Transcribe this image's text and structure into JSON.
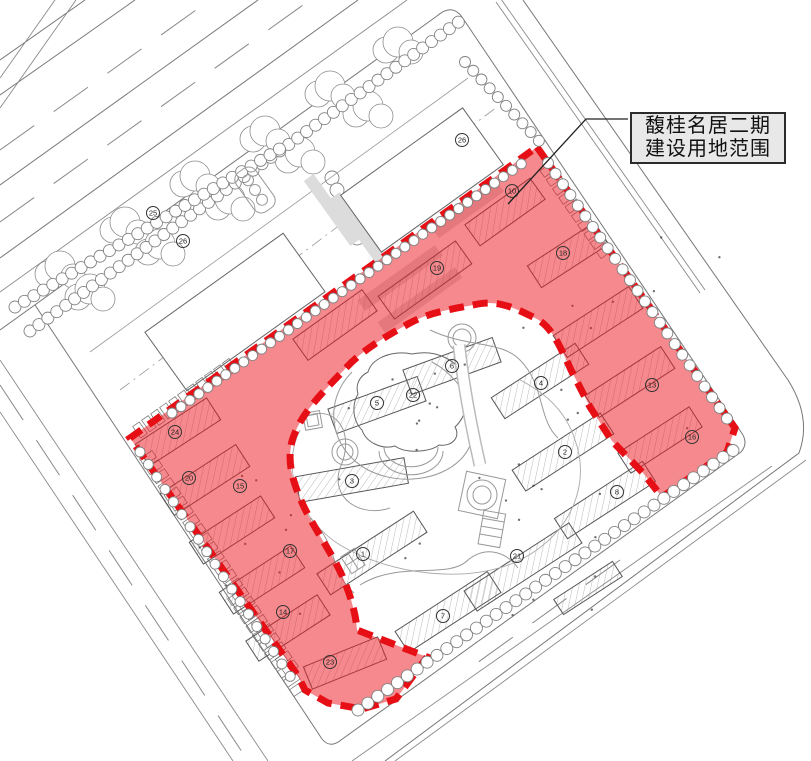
{
  "annotation": {
    "line1": "馥桂名居二期",
    "line2": "建设用地范围"
  },
  "colors": {
    "red_fill": "#ed1c24",
    "red_fill_opacity": "0.52",
    "red_dash": "#e60f16",
    "cad_line": "#777777",
    "label_bg": "#e8e8e8",
    "label_border": "#2b2b2b",
    "label_text": "#111111"
  },
  "building_numbers": [
    {
      "label": "25",
      "x": 153,
      "y": 213
    },
    {
      "label": "26",
      "x": 183,
      "y": 241
    },
    {
      "label": "26",
      "x": 462,
      "y": 140
    },
    {
      "label": "10",
      "x": 512,
      "y": 191
    },
    {
      "label": "18",
      "x": 563,
      "y": 253
    },
    {
      "label": "19",
      "x": 437,
      "y": 268
    },
    {
      "label": "13",
      "x": 652,
      "y": 385
    },
    {
      "label": "16",
      "x": 692,
      "y": 437
    },
    {
      "label": "24",
      "x": 175,
      "y": 432
    },
    {
      "label": "20",
      "x": 189,
      "y": 478
    },
    {
      "label": "15",
      "x": 240,
      "y": 486
    },
    {
      "label": "17",
      "x": 290,
      "y": 551
    },
    {
      "label": "14",
      "x": 283,
      "y": 612
    },
    {
      "label": "23",
      "x": 330,
      "y": 662
    },
    {
      "label": "22",
      "x": 413,
      "y": 395
    },
    {
      "label": "6",
      "x": 452,
      "y": 366
    },
    {
      "label": "5",
      "x": 377,
      "y": 403
    },
    {
      "label": "4",
      "x": 541,
      "y": 383
    },
    {
      "label": "3",
      "x": 352,
      "y": 481
    },
    {
      "label": "2",
      "x": 565,
      "y": 452
    },
    {
      "label": "1",
      "x": 363,
      "y": 554
    },
    {
      "label": "7",
      "x": 443,
      "y": 616
    },
    {
      "label": "8",
      "x": 617,
      "y": 492
    },
    {
      "label": "21",
      "x": 517,
      "y": 556
    }
  ]
}
